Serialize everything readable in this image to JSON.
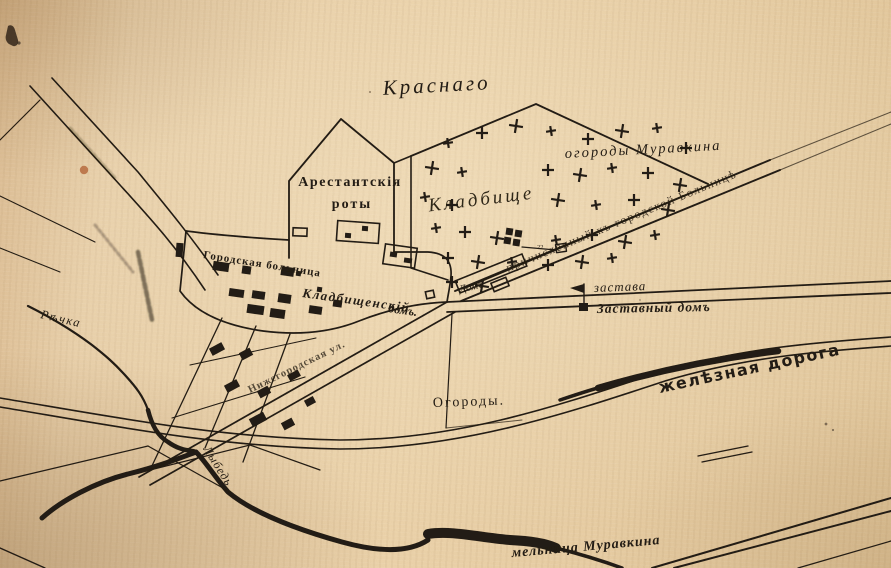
{
  "map": {
    "labels": {
      "krasnago": "Краснаго",
      "ogorody_muravkina": "огороды Муравкина",
      "arestantskiya": "Арестантскія",
      "roty": "роты",
      "kladbishche_cursive": "Кладбище",
      "gorodskaya_bolnitsa": "Городская больница",
      "kladbishchenskiy": "Кладбищенскій",
      "kladbishchenskiy_dom": "домъ.",
      "dom_u_dorogi": "Домъ",
      "prichislennyi": "причисленный къ городской Больницѣ",
      "zastava": "застава",
      "zastavnyi_dom": "Заставный домъ",
      "ogorody": "Огороды.",
      "zheleznaya_doroga": "желѣзная дорога",
      "melnitsa_muravkina": "мельница Муравкина",
      "rechka": "Рѣчка",
      "lybed": "Лыбедь",
      "street": "Нижегородская ул.",
      "cemetery_plot_number": "22"
    },
    "colors": {
      "paper": "#e8cea6",
      "ink": "#241b12",
      "stain": "#b5653a"
    }
  }
}
